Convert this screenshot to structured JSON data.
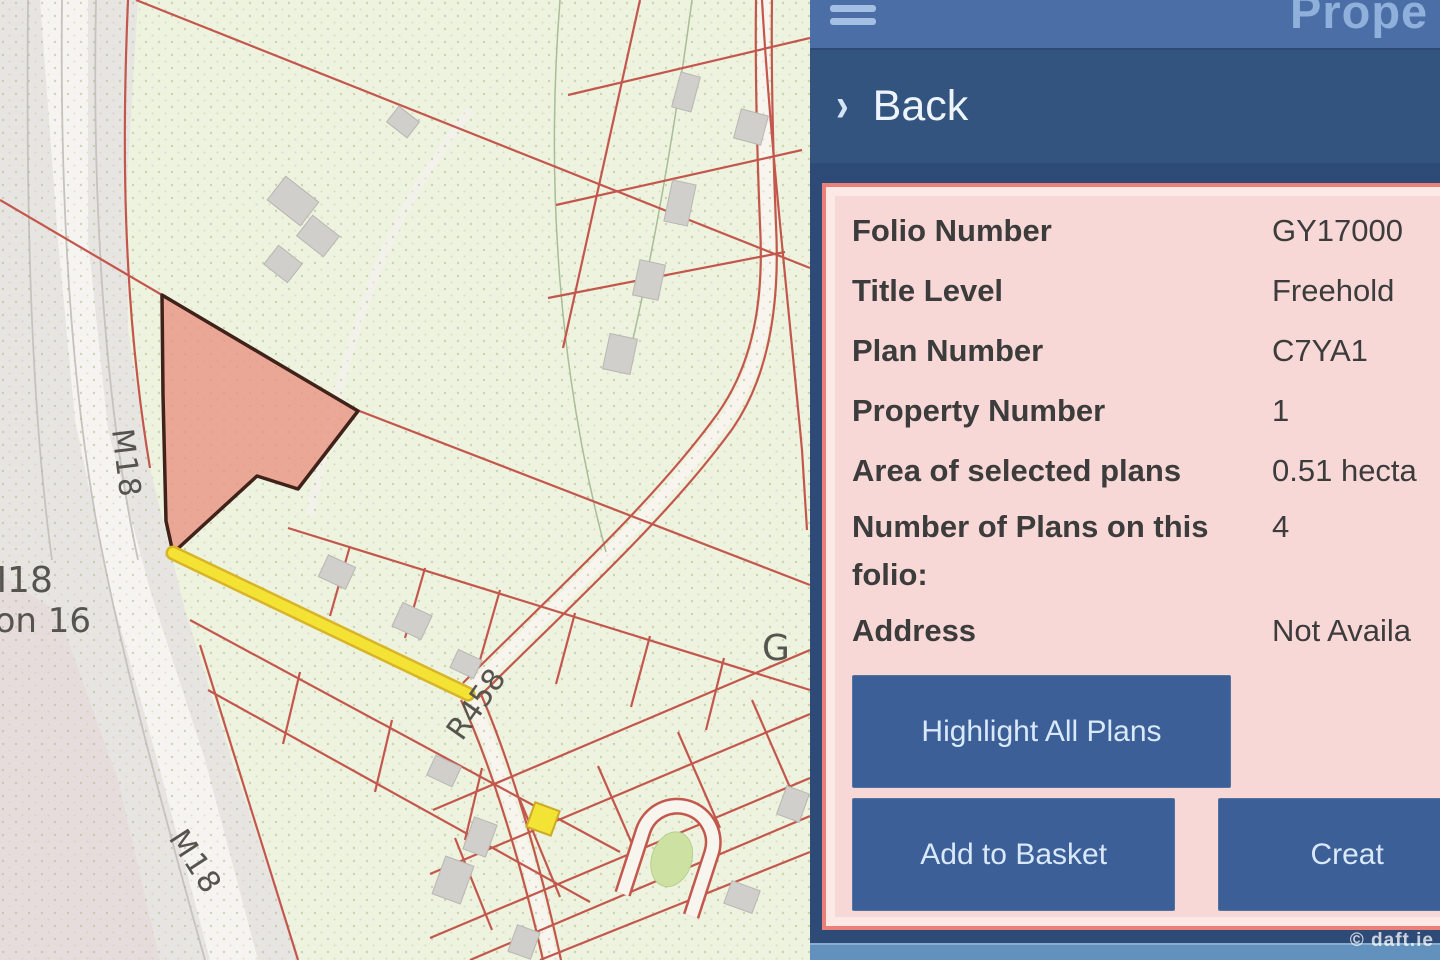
{
  "map": {
    "labels": {
      "m18": "M18",
      "junction": "Junction 16",
      "r458": "R458",
      "g_partial": "G"
    },
    "colors": {
      "selected_parcel_fill": "#e89482",
      "selected_parcel_border": "#40221a",
      "boundary_red": "#c3574d",
      "highlight_road_yellow": "#f4e334",
      "background_green": "#edf3de"
    }
  },
  "panel": {
    "title_partial": "Prope",
    "icons": {
      "menu": "hamburger-icon",
      "back_chevron_glyph": "›"
    },
    "back_label": "Back",
    "info": {
      "rows": [
        {
          "label": "Folio Number",
          "value": "GY17000"
        },
        {
          "label": "Title Level",
          "value": "Freehold"
        },
        {
          "label": "Plan Number",
          "value": "C7YA1"
        },
        {
          "label": "Property Number",
          "value": "1"
        },
        {
          "label": "Area of selected plans",
          "value": "0.51 hecta"
        },
        {
          "label": "Number of Plans on this folio:",
          "value": "4"
        },
        {
          "label": "Address",
          "value": "Not Availa"
        }
      ]
    },
    "buttons": {
      "highlight_all": "Highlight All Plans",
      "add_to_basket": "Add to Basket",
      "create_partial": "Creat"
    }
  },
  "watermark": "© daft.ie"
}
